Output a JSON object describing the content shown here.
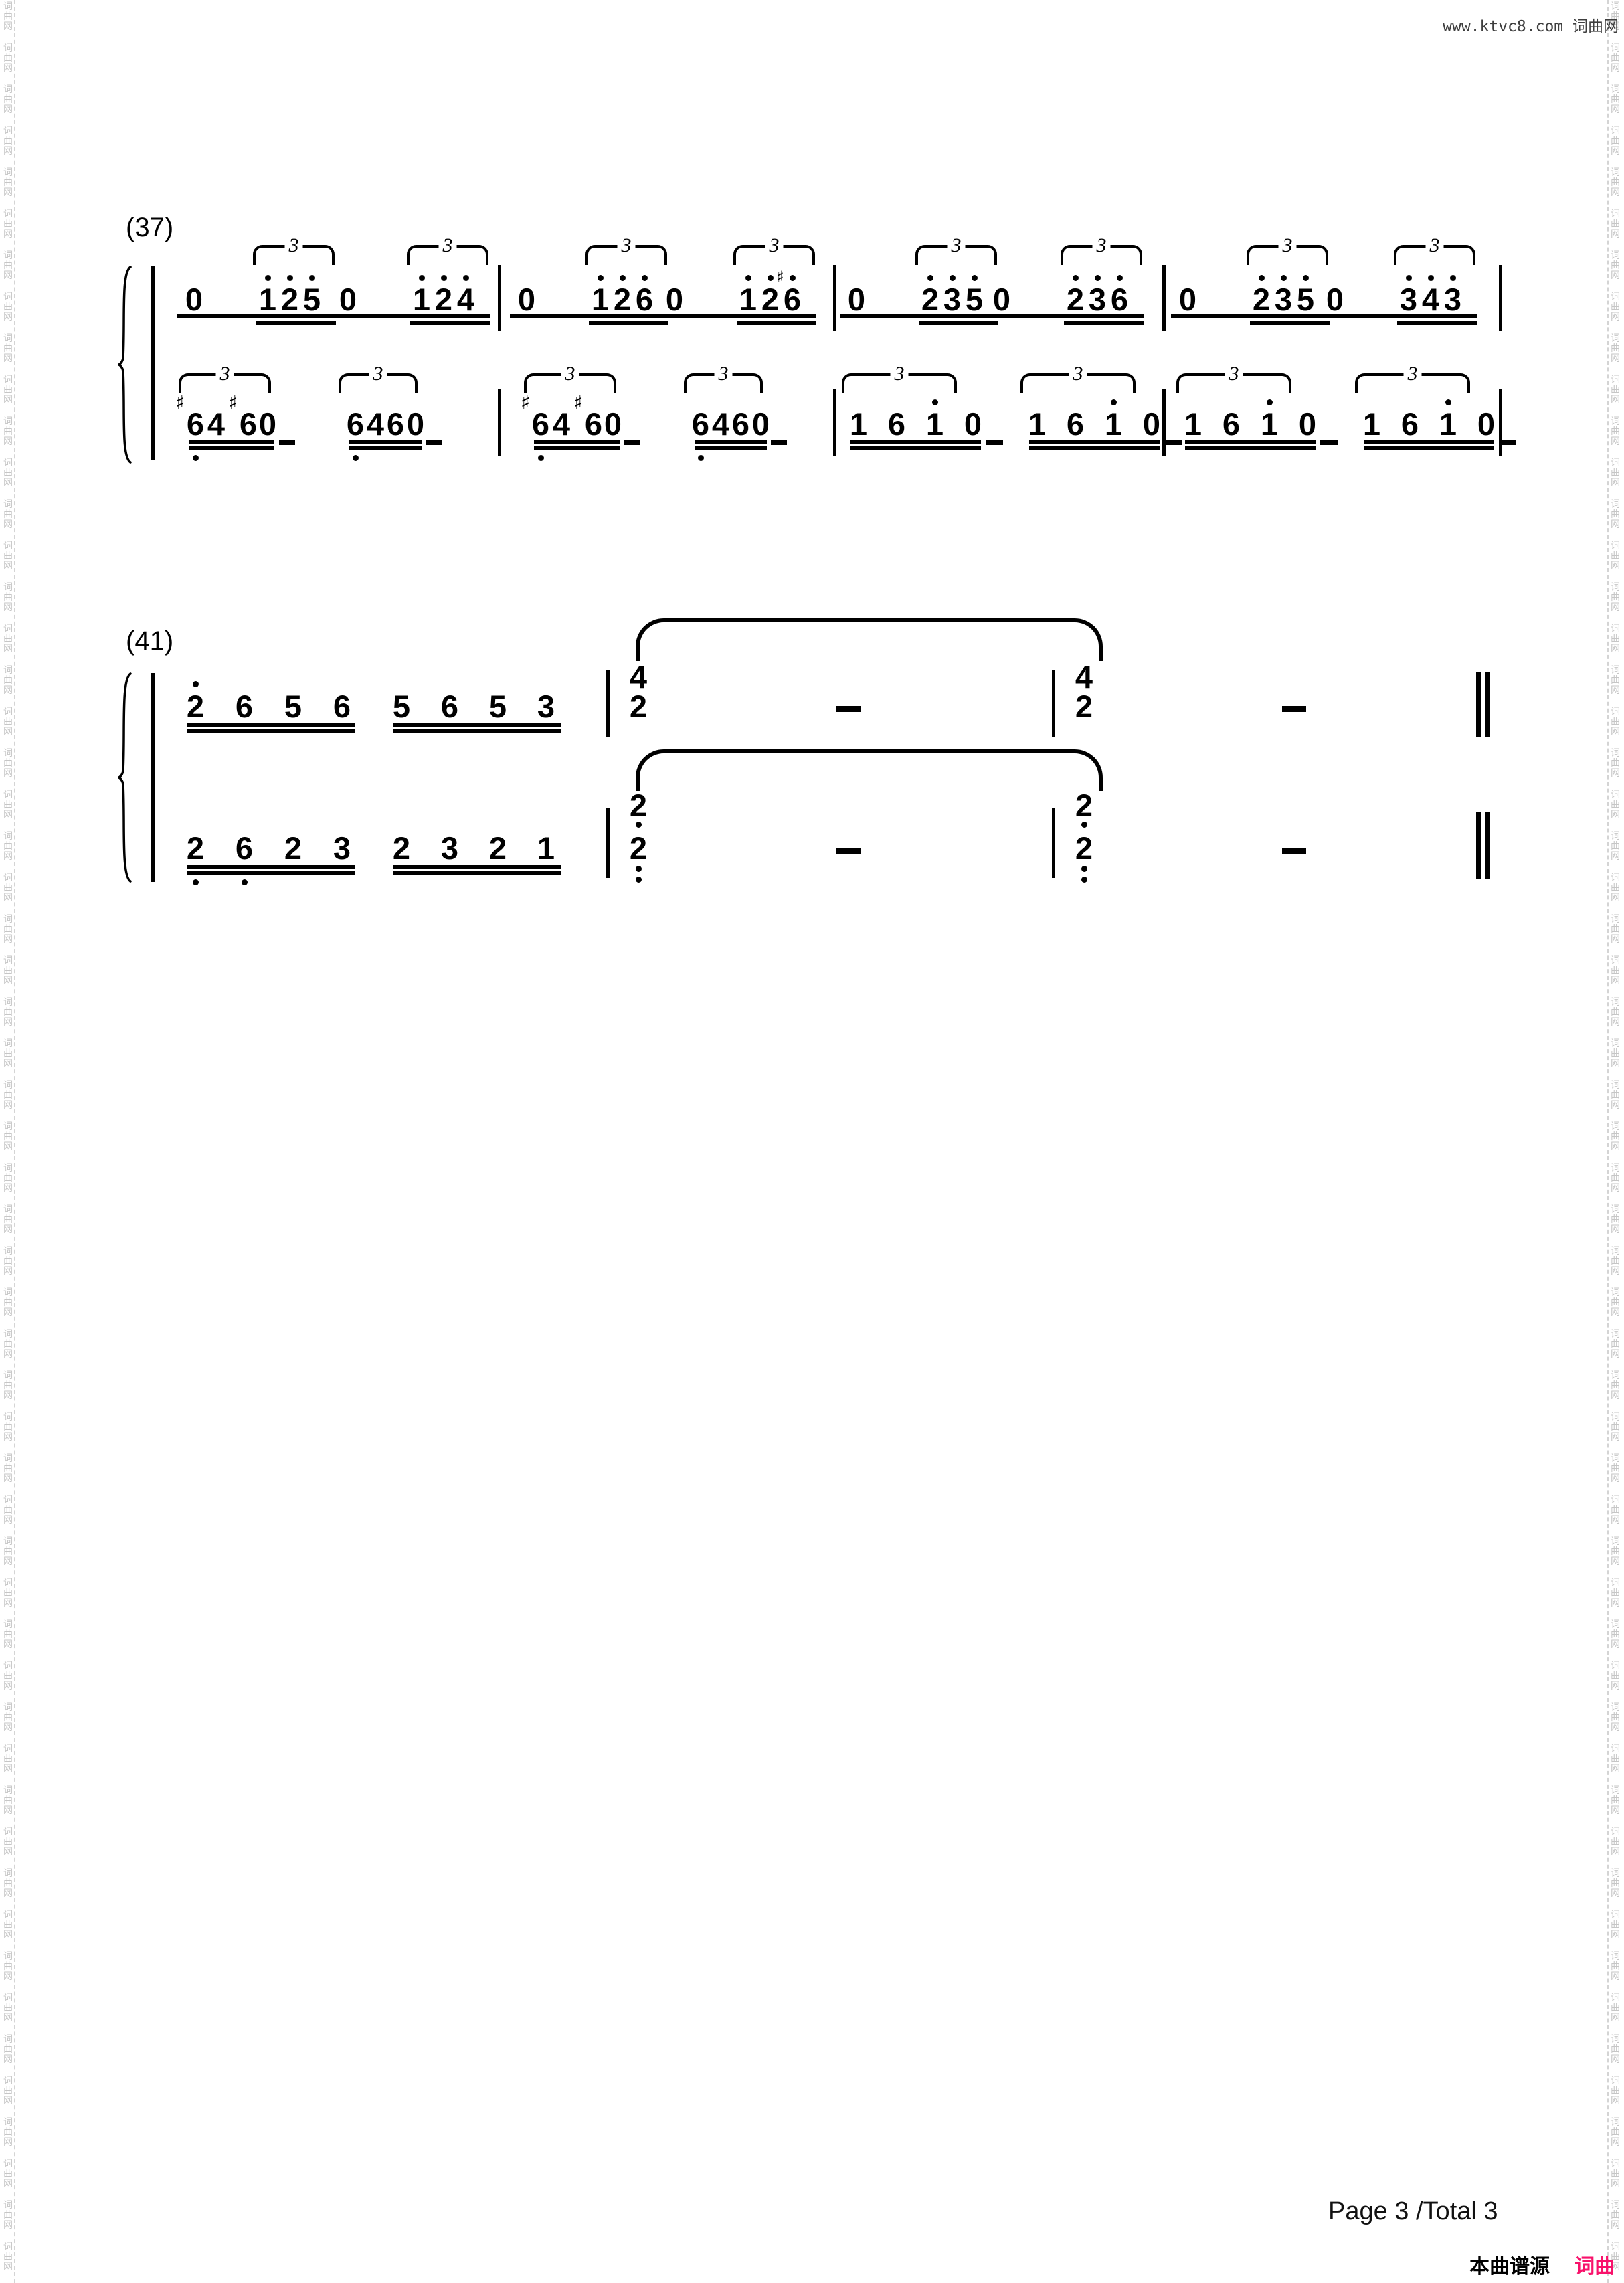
{
  "page": {
    "header_right": "www.ktvc8.com 词曲网",
    "watermark_chars": [
      "词",
      "曲",
      "网"
    ],
    "footer": {
      "page_info": "Page 3 /Total 3",
      "source_prefix": "本曲谱源自",
      "source_site": "词曲网"
    },
    "colors": {
      "accent_pink": "#f8126b",
      "watermark_gray": "#c6c6c6",
      "header_gray": "#3e3e3e"
    }
  },
  "music": {
    "notation": "jianpu",
    "systems": [
      {
        "label": "(37)",
        "staves": [
          {
            "name": "upper",
            "measures": [
              {
                "groups": [
                  {
                    "type": "rest_triplet",
                    "rest": "0",
                    "tuplet": "3",
                    "notes": [
                      {
                        "d": "1",
                        "hi": 1
                      },
                      {
                        "d": "2",
                        "hi": 1
                      },
                      {
                        "d": "5",
                        "hi": 1
                      }
                    ]
                  },
                  {
                    "type": "rest_triplet",
                    "rest": "0",
                    "tuplet": "3",
                    "notes": [
                      {
                        "d": "1",
                        "hi": 1
                      },
                      {
                        "d": "2",
                        "hi": 1
                      },
                      {
                        "d": "4",
                        "hi": 1
                      }
                    ]
                  }
                ]
              },
              {
                "groups": [
                  {
                    "type": "rest_triplet",
                    "rest": "0",
                    "tuplet": "3",
                    "notes": [
                      {
                        "d": "1",
                        "hi": 1
                      },
                      {
                        "d": "2",
                        "hi": 1
                      },
                      {
                        "d": "6",
                        "hi": 1
                      }
                    ]
                  },
                  {
                    "type": "rest_triplet",
                    "rest": "0",
                    "tuplet": "3",
                    "notes": [
                      {
                        "d": "1",
                        "hi": 1
                      },
                      {
                        "d": "2",
                        "hi": 1
                      },
                      {
                        "d": "6",
                        "hi": 1,
                        "acc": "♯"
                      }
                    ]
                  }
                ]
              },
              {
                "groups": [
                  {
                    "type": "rest_triplet",
                    "rest": "0",
                    "tuplet": "3",
                    "notes": [
                      {
                        "d": "2",
                        "hi": 1
                      },
                      {
                        "d": "3",
                        "hi": 1
                      },
                      {
                        "d": "5",
                        "hi": 1
                      }
                    ]
                  },
                  {
                    "type": "rest_triplet",
                    "rest": "0",
                    "tuplet": "3",
                    "notes": [
                      {
                        "d": "2",
                        "hi": 1
                      },
                      {
                        "d": "3",
                        "hi": 1
                      },
                      {
                        "d": "6",
                        "hi": 1
                      }
                    ]
                  }
                ]
              },
              {
                "groups": [
                  {
                    "type": "rest_triplet",
                    "rest": "0",
                    "tuplet": "3",
                    "notes": [
                      {
                        "d": "2",
                        "hi": 1
                      },
                      {
                        "d": "3",
                        "hi": 1
                      },
                      {
                        "d": "5",
                        "hi": 1
                      }
                    ]
                  },
                  {
                    "type": "rest_triplet",
                    "rest": "0",
                    "tuplet": "3",
                    "notes": [
                      {
                        "d": "3",
                        "hi": 1
                      },
                      {
                        "d": "4",
                        "hi": 1
                      },
                      {
                        "d": "3",
                        "hi": 1
                      }
                    ]
                  }
                ]
              }
            ]
          },
          {
            "name": "lower",
            "measures": [
              {
                "groups": [
                  {
                    "type": "triplet_rest",
                    "rest": "0",
                    "tuplet": "3",
                    "notes": [
                      {
                        "d": "6",
                        "acc": "♯",
                        "lo": 1
                      },
                      {
                        "d": "4"
                      },
                      {
                        "d": "6",
                        "acc": "♯"
                      }
                    ]
                  },
                  {
                    "type": "triplet_rest",
                    "rest": "0",
                    "tuplet": "3",
                    "notes": [
                      {
                        "d": "6",
                        "lo": 1
                      },
                      {
                        "d": "4"
                      },
                      {
                        "d": "6"
                      }
                    ]
                  }
                ]
              },
              {
                "groups": [
                  {
                    "type": "triplet_rest",
                    "rest": "0",
                    "tuplet": "3",
                    "notes": [
                      {
                        "d": "6",
                        "acc": "♯",
                        "lo": 1
                      },
                      {
                        "d": "4"
                      },
                      {
                        "d": "6",
                        "acc": "♯"
                      }
                    ]
                  },
                  {
                    "type": "triplet_rest",
                    "rest": "0",
                    "tuplet": "3",
                    "notes": [
                      {
                        "d": "6",
                        "lo": 1
                      },
                      {
                        "d": "4"
                      },
                      {
                        "d": "6"
                      }
                    ]
                  }
                ]
              },
              {
                "groups": [
                  {
                    "type": "triplet_rest",
                    "rest": "0",
                    "tuplet": "3",
                    "notes": [
                      {
                        "d": "1"
                      },
                      {
                        "d": "6"
                      },
                      {
                        "d": "1",
                        "hi": 1
                      }
                    ]
                  },
                  {
                    "type": "triplet_rest",
                    "rest": "0",
                    "tuplet": "3",
                    "notes": [
                      {
                        "d": "1"
                      },
                      {
                        "d": "6"
                      },
                      {
                        "d": "1",
                        "hi": 1
                      }
                    ]
                  }
                ]
              },
              {
                "groups": [
                  {
                    "type": "triplet_rest",
                    "rest": "0",
                    "tuplet": "3",
                    "notes": [
                      {
                        "d": "1"
                      },
                      {
                        "d": "6"
                      },
                      {
                        "d": "1",
                        "hi": 1
                      }
                    ]
                  },
                  {
                    "type": "triplet_rest",
                    "rest": "0",
                    "tuplet": "3",
                    "notes": [
                      {
                        "d": "1"
                      },
                      {
                        "d": "6"
                      },
                      {
                        "d": "1",
                        "hi": 1
                      }
                    ]
                  }
                ]
              }
            ]
          }
        ]
      },
      {
        "label": "(41)",
        "staves": [
          {
            "name": "upper",
            "tie": true,
            "end": "double",
            "measures": [
              {
                "groups": [
                  {
                    "type": "beam4",
                    "notes": [
                      {
                        "d": "2",
                        "hi": 1
                      },
                      {
                        "d": "6"
                      },
                      {
                        "d": "5"
                      },
                      {
                        "d": "6"
                      }
                    ]
                  },
                  {
                    "type": "beam4",
                    "notes": [
                      {
                        "d": "5"
                      },
                      {
                        "d": "6"
                      },
                      {
                        "d": "5"
                      },
                      {
                        "d": "3"
                      }
                    ]
                  }
                ]
              },
              {
                "groups": [
                  {
                    "type": "chord",
                    "notes": [
                      {
                        "d": "4"
                      },
                      {
                        "d": "2"
                      }
                    ]
                  },
                  {
                    "type": "dash"
                  }
                ]
              },
              {
                "groups": [
                  {
                    "type": "chord",
                    "notes": [
                      {
                        "d": "4"
                      },
                      {
                        "d": "2"
                      }
                    ]
                  },
                  {
                    "type": "dash"
                  }
                ]
              }
            ]
          },
          {
            "name": "lower",
            "tie": true,
            "end": "double",
            "measures": [
              {
                "groups": [
                  {
                    "type": "beam4",
                    "notes": [
                      {
                        "d": "2",
                        "lo": 1
                      },
                      {
                        "d": "6",
                        "lo": 1
                      },
                      {
                        "d": "2"
                      },
                      {
                        "d": "3"
                      }
                    ]
                  },
                  {
                    "type": "beam4",
                    "notes": [
                      {
                        "d": "2"
                      },
                      {
                        "d": "3"
                      },
                      {
                        "d": "2"
                      },
                      {
                        "d": "1"
                      }
                    ]
                  }
                ]
              },
              {
                "groups": [
                  {
                    "type": "chord",
                    "notes": [
                      {
                        "d": "2",
                        "lo": 1
                      },
                      {
                        "d": "2",
                        "lo": 2
                      }
                    ]
                  },
                  {
                    "type": "dash"
                  }
                ]
              },
              {
                "groups": [
                  {
                    "type": "chord",
                    "notes": [
                      {
                        "d": "2",
                        "lo": 1
                      },
                      {
                        "d": "2",
                        "lo": 2
                      }
                    ]
                  },
                  {
                    "type": "dash"
                  }
                ]
              }
            ]
          }
        ]
      }
    ]
  }
}
